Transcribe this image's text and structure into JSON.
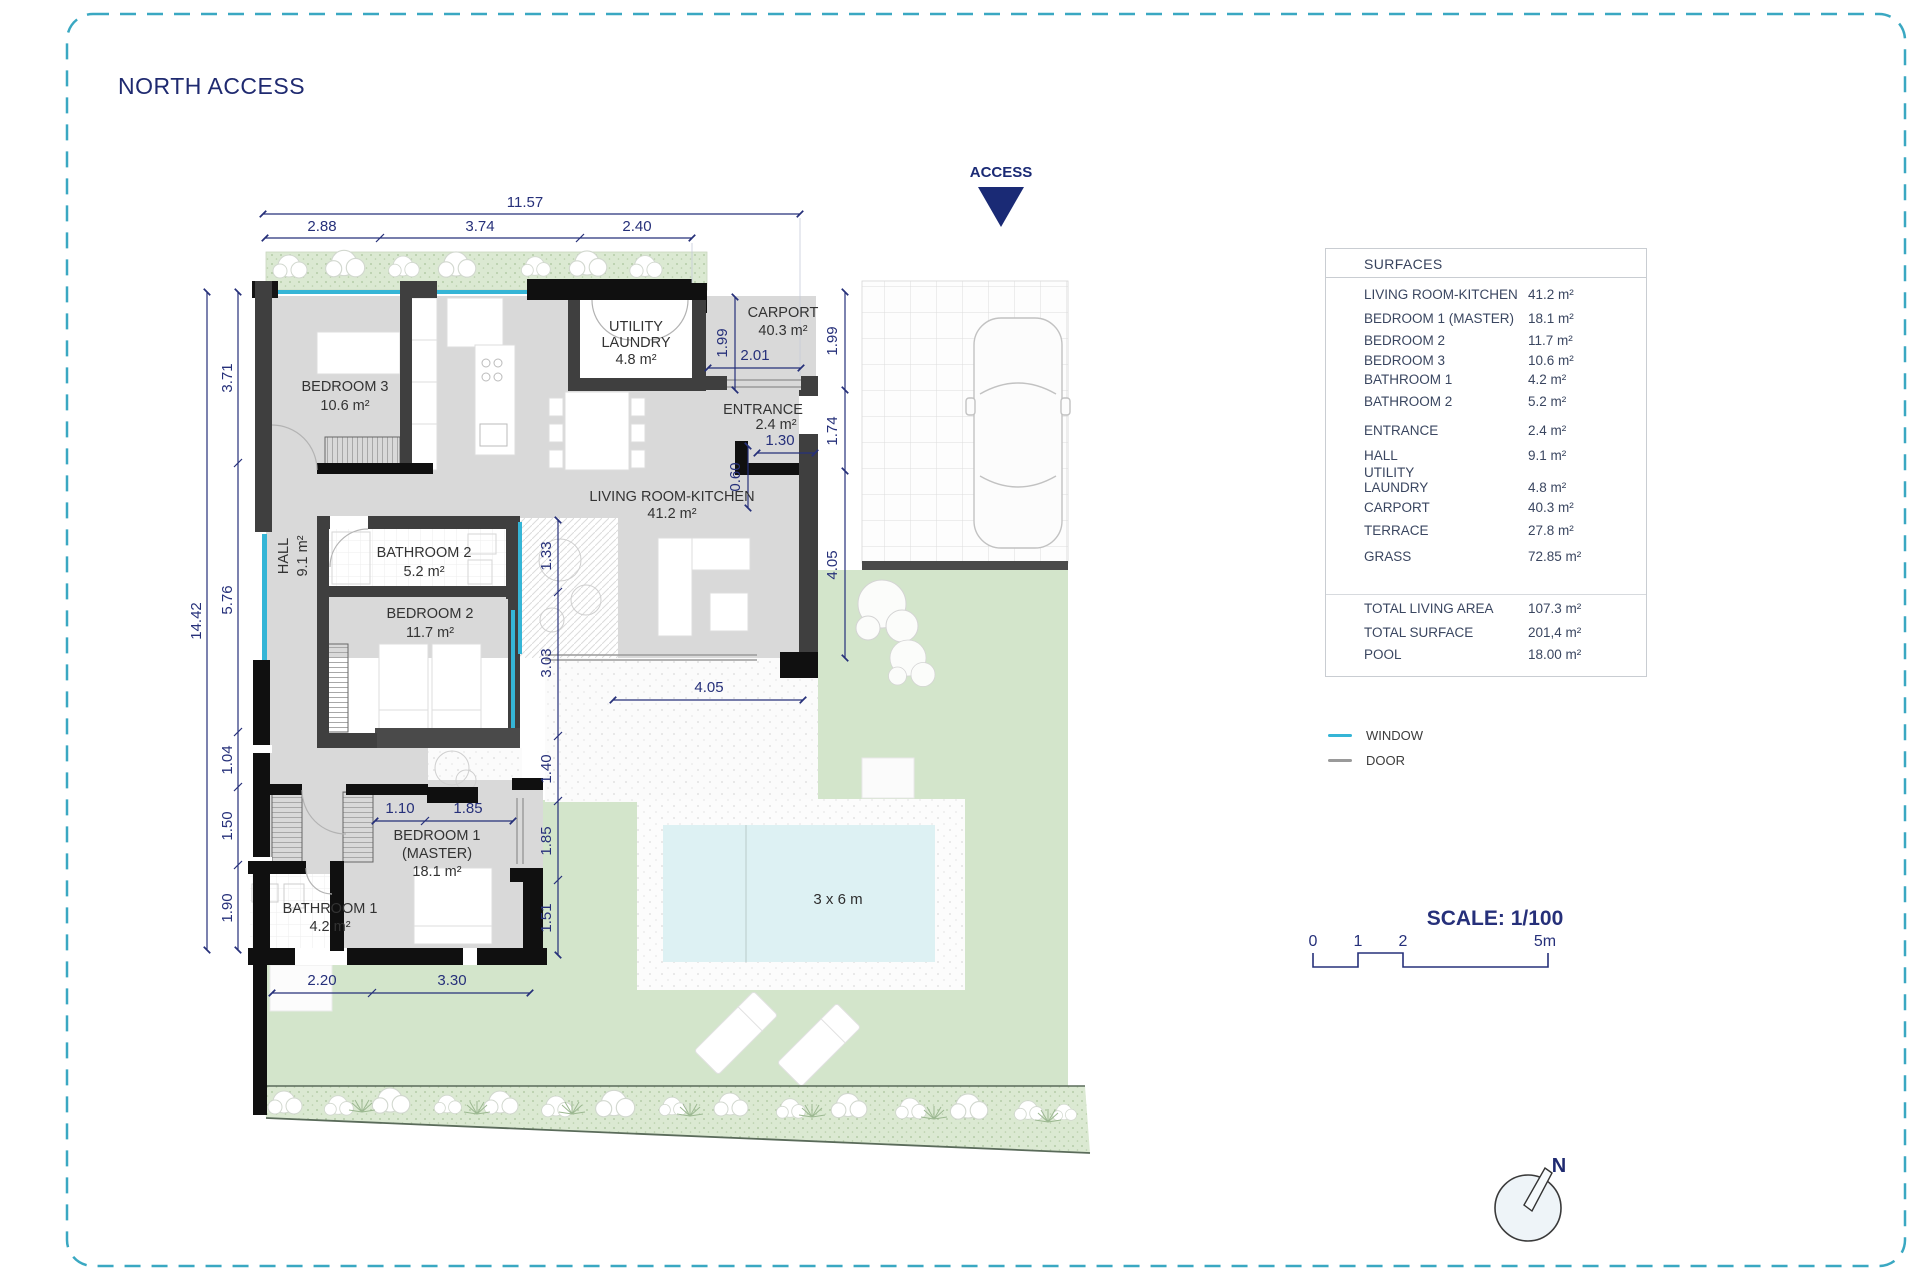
{
  "title": "NORTH ACCESS",
  "access_label": "ACCESS",
  "compass_label": "N",
  "scale": {
    "label": "SCALE: 1/100",
    "t0": "0",
    "t1": "1",
    "t2": "2",
    "t5": "5m"
  },
  "legend": {
    "window": "WINDOW",
    "door": "DOOR"
  },
  "surfaces": {
    "header": "SURFACES",
    "rows": [
      {
        "label": "LIVING ROOM-KITCHEN",
        "value": "41.2 m²"
      },
      {
        "label": "BEDROOM 1 (MASTER)",
        "value": "18.1 m²"
      },
      {
        "label": "BEDROOM 2",
        "value": "11.7 m²"
      },
      {
        "label": "BEDROOM 3",
        "value": "10.6 m²"
      },
      {
        "label": "BATHROOM 1",
        "value": "4.2 m²"
      },
      {
        "label": "BATHROOM 2",
        "value": "5.2 m²"
      },
      {
        "label": "ENTRANCE",
        "value": "2.4 m²"
      },
      {
        "label": "HALL",
        "value": "9.1 m²"
      },
      {
        "label": "UTILITY LAUNDRY",
        "value": "4.8 m²"
      },
      {
        "label": "CARPORT",
        "value": "40.3 m²"
      },
      {
        "label": "TERRACE",
        "value": "27.8 m²"
      },
      {
        "label": "GRASS",
        "value": "72.85 m²"
      }
    ],
    "totals": [
      {
        "label": "TOTAL LIVING AREA",
        "value": "107.3 m²"
      },
      {
        "label": "TOTAL SURFACE",
        "value": "201,4 m²"
      },
      {
        "label": "POOL",
        "value": "18.00 m²"
      }
    ]
  },
  "rooms": {
    "bedroom3": {
      "l1": "BEDROOM 3",
      "l2": "10.6 m²"
    },
    "hall": {
      "l1": "HALL",
      "l2": "9.1 m²"
    },
    "bathroom2": {
      "l1": "BATHROOM 2",
      "l2": "5.2 m²"
    },
    "bedroom2": {
      "l1": "BEDROOM 2",
      "l2": "11.7 m²"
    },
    "bedroom1": {
      "l1": "BEDROOM 1",
      "l2": "(MASTER)",
      "l3": "18.1 m²"
    },
    "bathroom1": {
      "l1": "BATHROOM 1",
      "l2": "4.2 m²"
    },
    "utility": {
      "l1": "UTILITY",
      "l2": "LAUNDRY",
      "l3": "4.8 m²"
    },
    "entrance": {
      "l1": "ENTRANCE",
      "l2": "2.4 m²"
    },
    "living": {
      "l1": "LIVING ROOM-KITCHEN",
      "l2": "41.2 m²"
    },
    "carport": {
      "l1": "CARPORT",
      "l2": "40.3 m²"
    },
    "pool": {
      "label": "3 x 6 m"
    }
  },
  "dims": {
    "w_total": "11.57",
    "w_a": "2.88",
    "w_b": "3.74",
    "w_c": "2.40",
    "h_total": "14.42",
    "h_a": "3.71",
    "h_b": "5.76",
    "h_c": "1.04",
    "h_d": "1.50",
    "h_e": "1.90",
    "r_a": "1.33",
    "r_b": "3.03",
    "r_c": "1.40",
    "r_d": "1.85",
    "r_e": "1.51",
    "m_a": "1.10",
    "m_b": "1.85",
    "b_a": "2.20",
    "b_b": "3.30",
    "c_a": "1.99",
    "c_b": "2.01",
    "c_c": "1.99",
    "c_d": "1.74",
    "c_e": "4.05",
    "c_f": "0.60",
    "c_g": "1.30",
    "c_h": "4.05"
  },
  "colors": {
    "accent_navy": "#26307a",
    "window_cyan": "#35b5d6",
    "door_gray": "#9a9a9a",
    "grass_green": "#d3e5cb",
    "pool_blue": "#ddf1f3",
    "wall_dark": "#434343"
  }
}
